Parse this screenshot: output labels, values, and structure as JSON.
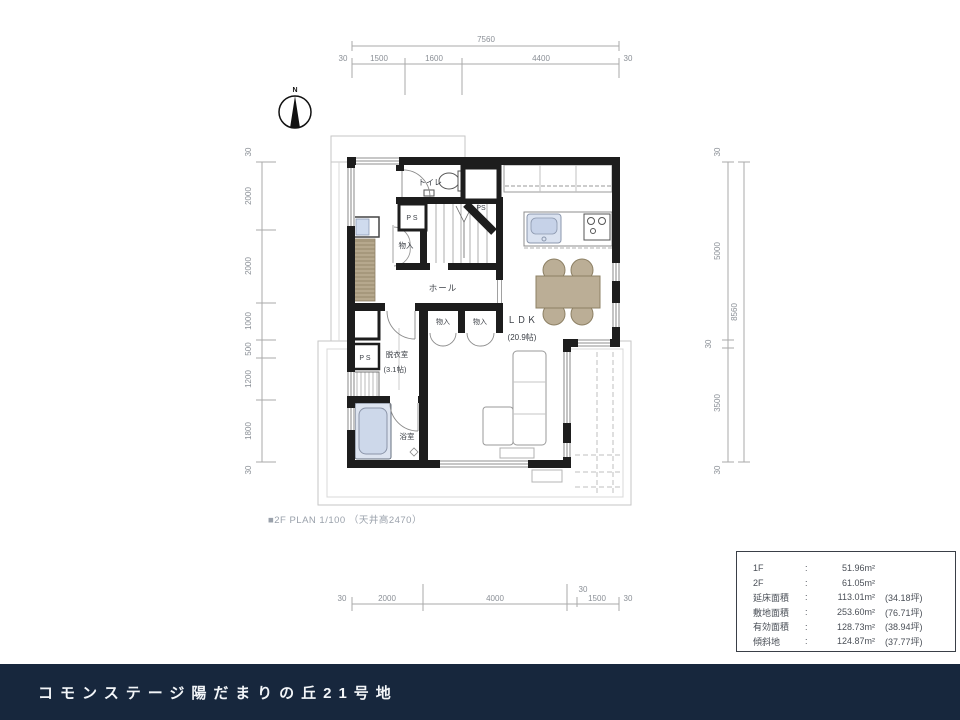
{
  "title_bar": {
    "label": "コモンステージ陽だまりの丘21号地",
    "bg": "#17273d"
  },
  "plan_caption": "■2F PLAN 1/100 （天井高2470）",
  "compass": {
    "north_label": "N"
  },
  "dims": {
    "top": {
      "total": "7560",
      "segments": [
        "30",
        "1500",
        "1600",
        "4400",
        "30"
      ]
    },
    "left": {
      "segments": [
        "30",
        "2000",
        "2000",
        "1000",
        "500",
        "1200",
        "1800",
        "30"
      ]
    },
    "right": {
      "total": "8560",
      "segments": [
        "30",
        "5000",
        "30",
        "3500",
        "30"
      ]
    },
    "bottom": {
      "segments": [
        "30",
        "2000",
        "4000",
        "1500",
        "30"
      ],
      "wall_offset": "30"
    }
  },
  "rooms": {
    "toilet": "トイレ",
    "ps_upper_left": "P S",
    "ps_upper_right": "PS",
    "closet_upper": "物入",
    "hall": "ホール",
    "closet_1": "物入",
    "closet_2": "物入",
    "ldk": "ＬＤＫ",
    "ldk_size": "(20.9帖)",
    "dressing": "脱衣室",
    "dressing_size": "(3.1帖)",
    "ps_lower": "P S",
    "bath": "浴室"
  },
  "area_table": {
    "rows": [
      {
        "label": "1F",
        "colon": ":",
        "value": "51.96m²",
        "tsubo": ""
      },
      {
        "label": "2F",
        "colon": ":",
        "value": "61.05m²",
        "tsubo": ""
      },
      {
        "label": "延床面積",
        "colon": ":",
        "value": "113.01m²",
        "tsubo": "(34.18坪)"
      },
      {
        "label": "敷地面積",
        "colon": ":",
        "value": "253.60m²",
        "tsubo": "(76.71坪)"
      },
      {
        "label": "有効面積",
        "colon": ":",
        "value": "128.73m²",
        "tsubo": "(38.94坪)"
      },
      {
        "label": "傾斜地",
        "colon": ":",
        "value": "124.87m²",
        "tsubo": "(37.77坪)"
      }
    ]
  },
  "colors": {
    "wall": "#1d1d1d",
    "accent_navy": "#17273d",
    "wood": "#b6a88d",
    "furniture_tan": "#bbae96",
    "fixture_blue": "#cdd8ea"
  }
}
